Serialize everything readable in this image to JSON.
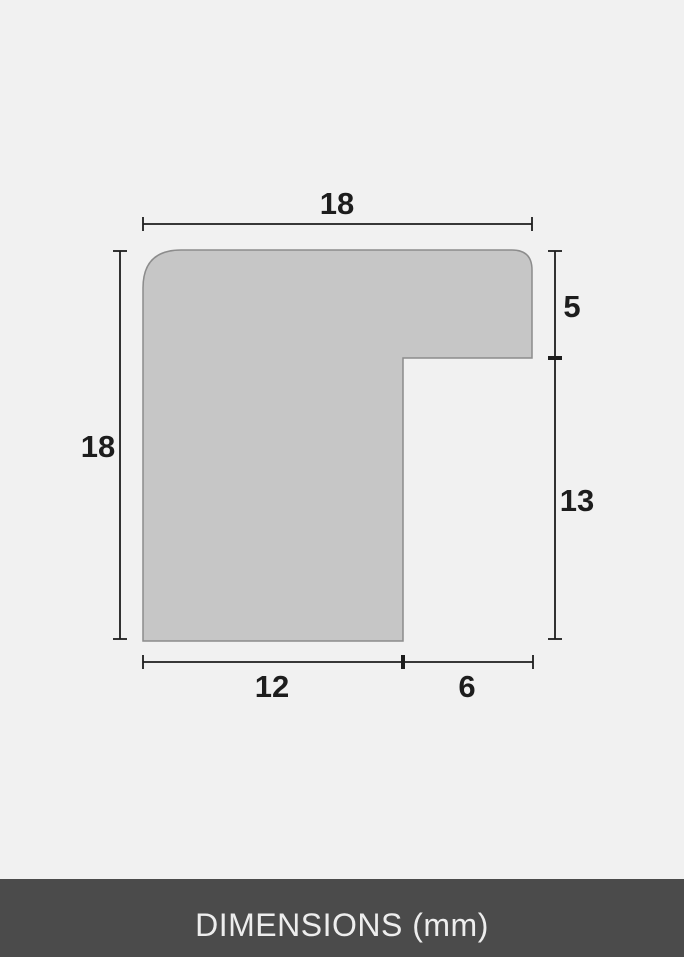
{
  "diagram": {
    "dimensions": {
      "top_width": "18",
      "left_height": "18",
      "right_upper": "5",
      "right_lower": "13",
      "bottom_left": "12",
      "bottom_right": "6"
    },
    "unit": "mm"
  },
  "footer": {
    "label": "DIMENSIONS (mm)"
  },
  "colors": {
    "background": "#f1f1f1",
    "shape_fill": "#c6c6c6",
    "shape_stroke": "#8c8c8c",
    "dim_line": "#1d1d1d",
    "footer_bg": "#4b4b4b",
    "footer_text": "#ededed"
  }
}
